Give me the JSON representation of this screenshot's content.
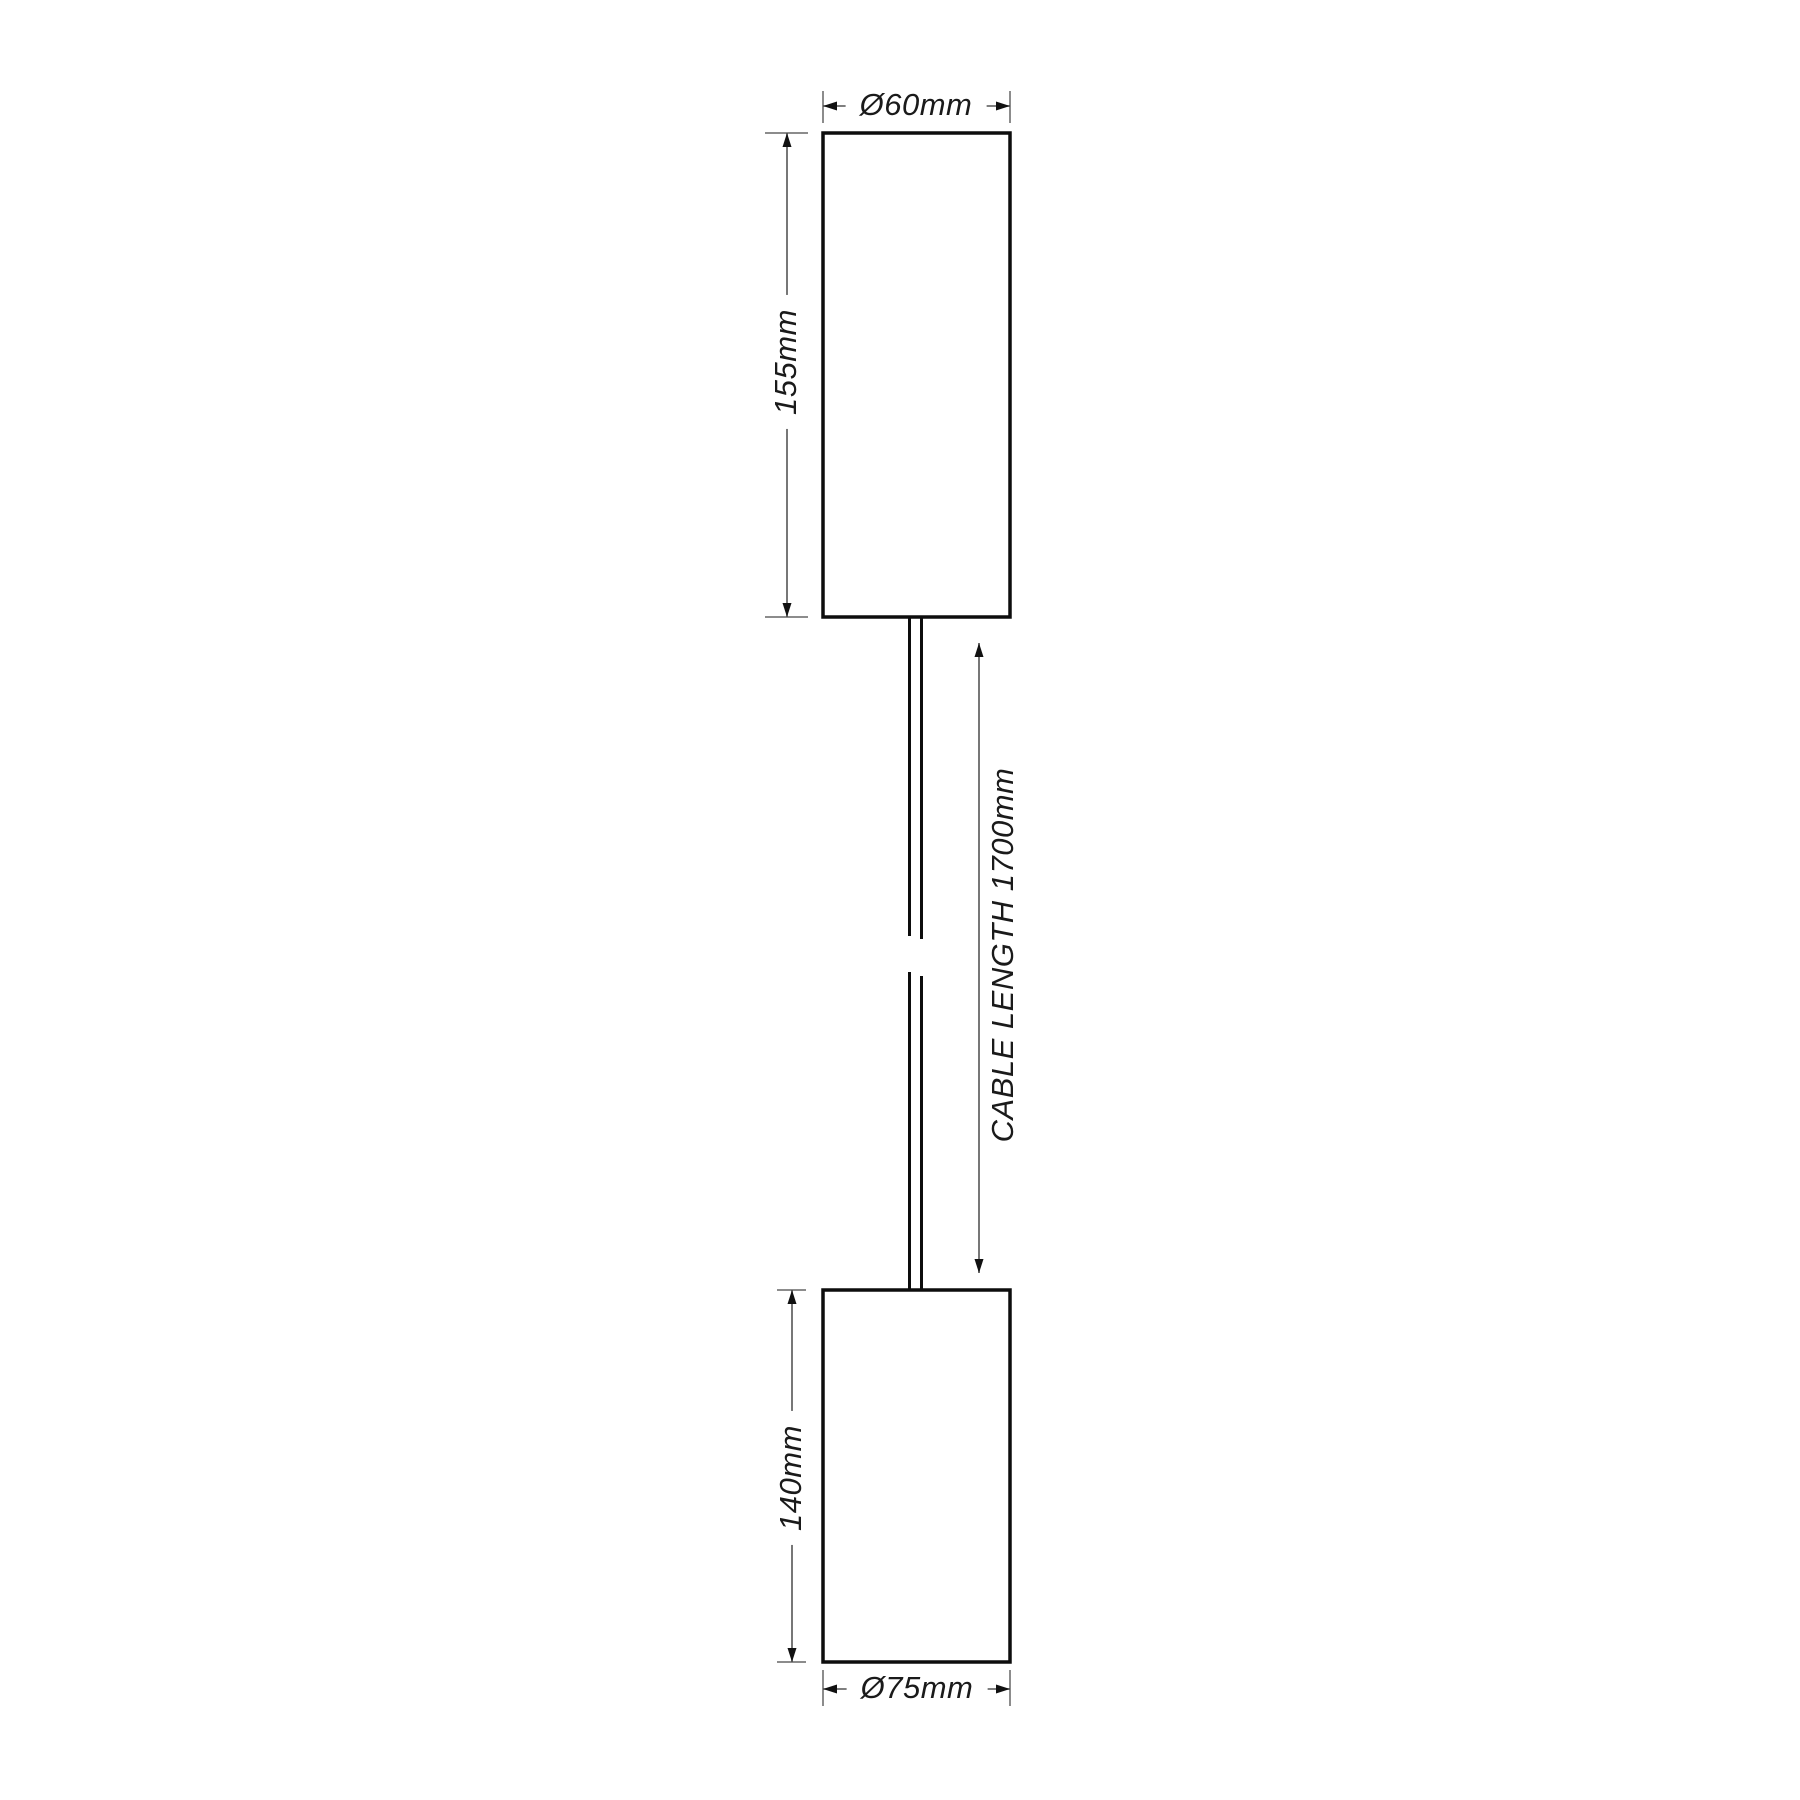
{
  "drawing": {
    "labels": {
      "top_diameter": "Ø60mm",
      "top_height": "155mm",
      "cable_length": "CABLE LENGTH 1700mm",
      "bottom_height": "140mm",
      "bottom_diameter": "Ø75mm"
    },
    "colors": {
      "background": "#ffffff",
      "outline": "#0d0d0d",
      "dimension_line": "#555555",
      "extension_line": "#8c8c8c",
      "text": "#1a1a1a"
    }
  }
}
